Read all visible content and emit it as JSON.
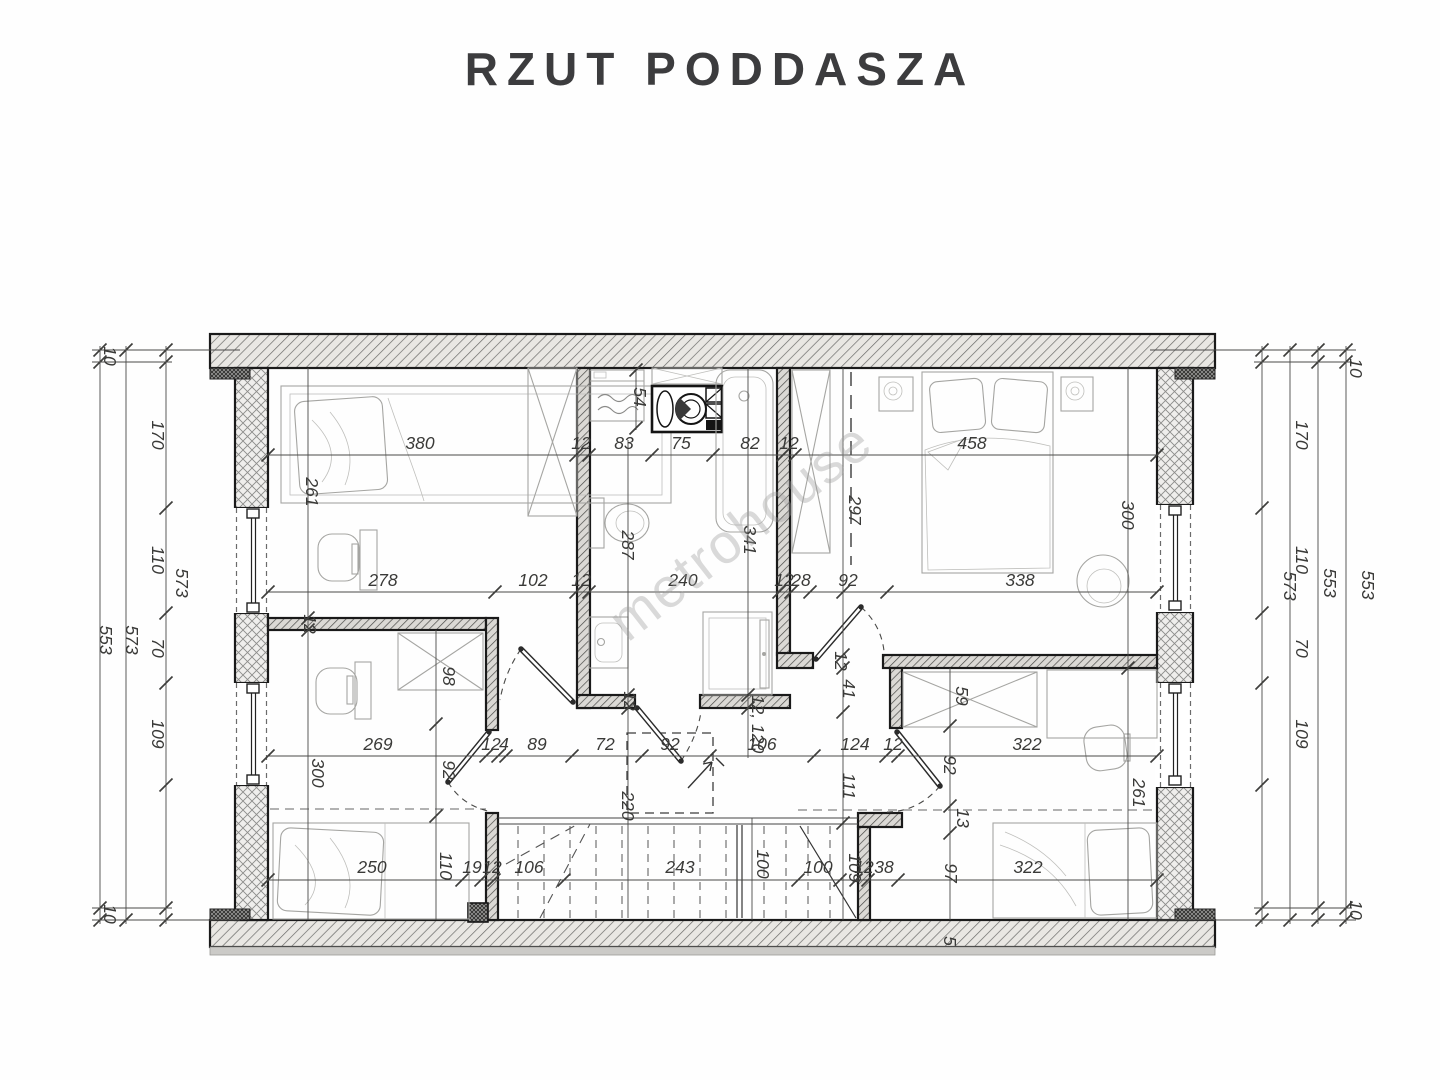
{
  "title": "RZUT PODDASZA",
  "watermark": "metrohouse",
  "dim_labels": [
    {
      "t": "380",
      "x": 420,
      "y": 449,
      "r": 0
    },
    {
      "t": "12",
      "x": 581,
      "y": 449,
      "r": 0
    },
    {
      "t": "83",
      "x": 624,
      "y": 449,
      "r": 0
    },
    {
      "t": "75",
      "x": 681,
      "y": 449,
      "r": 0
    },
    {
      "t": "82",
      "x": 750,
      "y": 449,
      "r": 0
    },
    {
      "t": "12",
      "x": 789,
      "y": 449,
      "r": 0
    },
    {
      "t": "458",
      "x": 972,
      "y": 449,
      "r": 0
    },
    {
      "t": "278",
      "x": 383,
      "y": 586,
      "r": 0
    },
    {
      "t": "102",
      "x": 533,
      "y": 586,
      "r": 0
    },
    {
      "t": "12",
      "x": 581,
      "y": 586,
      "r": 0
    },
    {
      "t": "240",
      "x": 683,
      "y": 586,
      "r": 0
    },
    {
      "t": "12",
      "x": 784,
      "y": 586,
      "r": 0
    },
    {
      "t": "28",
      "x": 801,
      "y": 586,
      "r": 0
    },
    {
      "t": "92",
      "x": 848,
      "y": 586,
      "r": 0
    },
    {
      "t": "338",
      "x": 1020,
      "y": 586,
      "r": 0
    },
    {
      "t": "269",
      "x": 378,
      "y": 750,
      "r": 0
    },
    {
      "t": "12",
      "x": 491,
      "y": 750,
      "r": 0
    },
    {
      "t": "4",
      "x": 504,
      "y": 750,
      "r": 0
    },
    {
      "t": "89",
      "x": 537,
      "y": 750,
      "r": 0
    },
    {
      "t": "72",
      "x": 605,
      "y": 750,
      "r": 0
    },
    {
      "t": "92",
      "x": 670,
      "y": 750,
      "r": 0
    },
    {
      "t": "106",
      "x": 762,
      "y": 750,
      "r": 0
    },
    {
      "t": "124",
      "x": 855,
      "y": 750,
      "r": 0
    },
    {
      "t": "12",
      "x": 893,
      "y": 750,
      "r": 0
    },
    {
      "t": "322",
      "x": 1027,
      "y": 750,
      "r": 0
    },
    {
      "t": "250",
      "x": 372,
      "y": 873,
      "r": 0
    },
    {
      "t": "19",
      "x": 472,
      "y": 873,
      "r": 0
    },
    {
      "t": "12",
      "x": 492,
      "y": 873,
      "r": 0
    },
    {
      "t": "106",
      "x": 529,
      "y": 873,
      "r": 0
    },
    {
      "t": "243",
      "x": 680,
      "y": 873,
      "r": 0
    },
    {
      "t": "100",
      "x": 818,
      "y": 873,
      "r": 0
    },
    {
      "t": "12",
      "x": 864,
      "y": 873,
      "r": 0
    },
    {
      "t": "38",
      "x": 884,
      "y": 873,
      "r": 0
    },
    {
      "t": "322",
      "x": 1028,
      "y": 873,
      "r": 0
    },
    {
      "t": "10",
      "x": 104,
      "y": 356,
      "r": 90
    },
    {
      "t": "553",
      "x": 100,
      "y": 640,
      "r": 90
    },
    {
      "t": "573",
      "x": 126,
      "y": 640,
      "r": 90
    },
    {
      "t": "170",
      "x": 152,
      "y": 435,
      "r": 90
    },
    {
      "t": "110",
      "x": 152,
      "y": 560,
      "r": 90
    },
    {
      "t": "70",
      "x": 152,
      "y": 648,
      "r": 90
    },
    {
      "t": "109",
      "x": 152,
      "y": 734,
      "r": 90
    },
    {
      "t": "573",
      "x": 176,
      "y": 583,
      "r": 90
    },
    {
      "t": "10",
      "x": 104,
      "y": 914,
      "r": 90
    },
    {
      "t": "170",
      "x": 1296,
      "y": 435,
      "r": 90
    },
    {
      "t": "110",
      "x": 1296,
      "y": 560,
      "r": 90
    },
    {
      "t": "70",
      "x": 1296,
      "y": 648,
      "r": 90
    },
    {
      "t": "109",
      "x": 1296,
      "y": 734,
      "r": 90
    },
    {
      "t": "573",
      "x": 1284,
      "y": 586,
      "r": 90
    },
    {
      "t": "553",
      "x": 1324,
      "y": 583,
      "r": 90
    },
    {
      "t": "553",
      "x": 1362,
      "y": 585,
      "r": 90
    },
    {
      "t": "10",
      "x": 1350,
      "y": 368,
      "r": 90
    },
    {
      "t": "10",
      "x": 1350,
      "y": 910,
      "r": 90
    },
    {
      "t": "261",
      "x": 306,
      "y": 492,
      "r": 90
    },
    {
      "t": "12",
      "x": 304,
      "y": 624,
      "r": 90
    },
    {
      "t": "300",
      "x": 312,
      "y": 773,
      "r": 90
    },
    {
      "t": "54",
      "x": 634,
      "y": 397,
      "r": 90
    },
    {
      "t": "287",
      "x": 622,
      "y": 545,
      "r": 90
    },
    {
      "t": "341",
      "x": 744,
      "y": 540,
      "r": 90
    },
    {
      "t": "12",
      "x": 624,
      "y": 701,
      "r": 90
    },
    {
      "t": "220",
      "x": 622,
      "y": 806,
      "r": 90
    },
    {
      "t": "12, 120",
      "x": 752,
      "y": 724,
      "r": 90
    },
    {
      "t": "297",
      "x": 849,
      "y": 510,
      "r": 90
    },
    {
      "t": "12",
      "x": 835,
      "y": 661,
      "r": 90
    },
    {
      "t": "41",
      "x": 843,
      "y": 689,
      "r": 90
    },
    {
      "t": "111",
      "x": 843,
      "y": 786,
      "r": 90
    },
    {
      "t": "109",
      "x": 849,
      "y": 868,
      "r": 90
    },
    {
      "t": "59",
      "x": 956,
      "y": 696,
      "r": 90
    },
    {
      "t": "92",
      "x": 944,
      "y": 765,
      "r": 90
    },
    {
      "t": "13",
      "x": 957,
      "y": 818,
      "r": 90
    },
    {
      "t": "97",
      "x": 945,
      "y": 873,
      "r": 90
    },
    {
      "t": "300",
      "x": 1122,
      "y": 515,
      "r": 90
    },
    {
      "t": "261",
      "x": 1133,
      "y": 793,
      "r": 90
    },
    {
      "t": "98",
      "x": 443,
      "y": 676,
      "r": 90
    },
    {
      "t": "92",
      "x": 443,
      "y": 770,
      "r": 90
    },
    {
      "t": "110",
      "x": 440,
      "y": 866,
      "r": 90
    },
    {
      "t": "100",
      "x": 757,
      "y": 864,
      "r": 90
    },
    {
      "t": "5",
      "x": 944,
      "y": 941,
      "r": 90
    }
  ],
  "rooms": {
    "top_left_bedroom": {
      "furniture": [
        "single-bed",
        "desk",
        "chair",
        "wardrobe"
      ]
    },
    "bathroom": {
      "furniture": [
        "washing-machine",
        "washer-dryer-column",
        "bathtub",
        "toilet",
        "sink",
        "shower"
      ]
    },
    "master_bedroom": {
      "furniture": [
        "double-bed",
        "nightstand-left",
        "nightstand-right",
        "wardrobe",
        "armchair"
      ]
    },
    "bottom_left_bedroom": {
      "furniture": [
        "single-bed",
        "desk",
        "chair",
        "wardrobe"
      ]
    },
    "bottom_right_bedroom": {
      "furniture": [
        "single-bed",
        "desk",
        "chair",
        "wardrobe"
      ]
    },
    "hall": {
      "features": [
        "staircase",
        "railing",
        "door-swings"
      ]
    }
  }
}
